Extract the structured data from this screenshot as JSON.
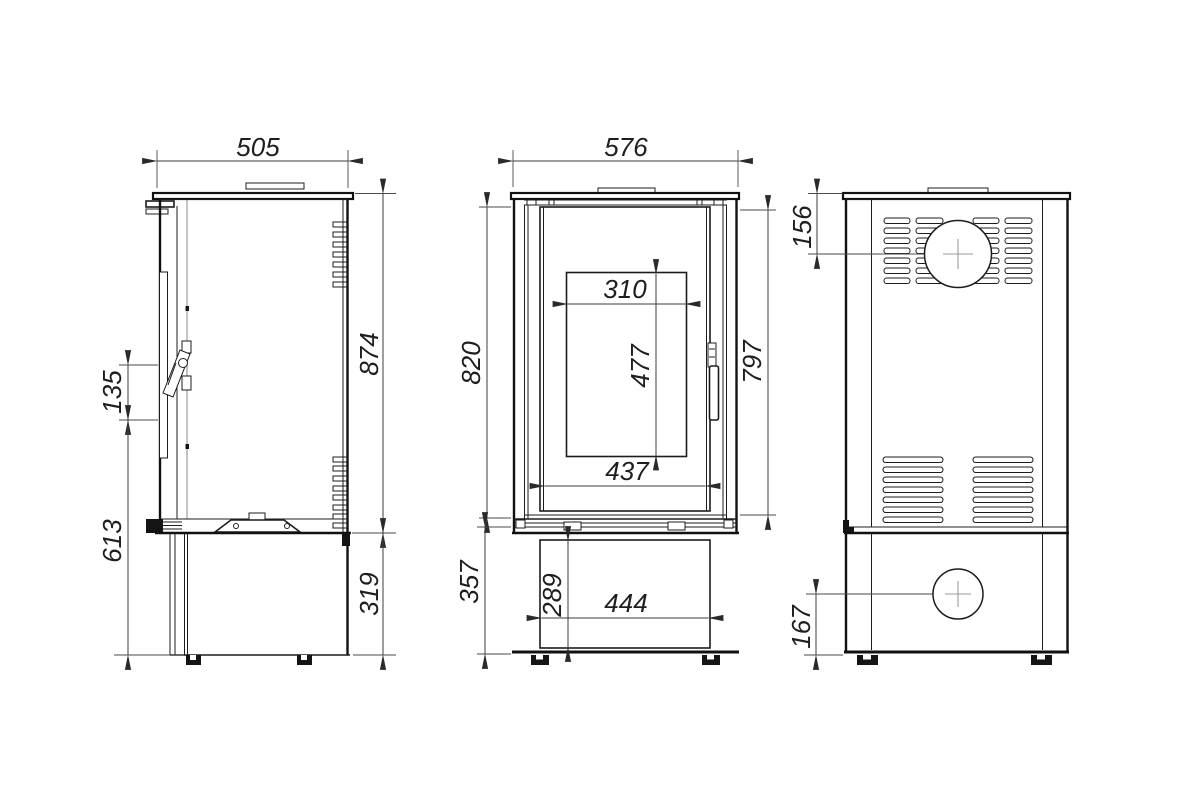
{
  "views": {
    "side": {
      "dims": {
        "top_width": "505",
        "body_height": "874",
        "handle_recess_height": "135",
        "front_lower_height": "613",
        "base_height": "319"
      }
    },
    "front": {
      "dims": {
        "top_width": "576",
        "body_height_left": "820",
        "door_height_right": "797",
        "glass_width": "310",
        "glass_height": "477",
        "door_inner_width": "437",
        "base_height": "357",
        "base_panel_height": "289",
        "base_panel_width": "444"
      }
    },
    "rear": {
      "dims": {
        "flue_center_from_top": "156",
        "inlet_center_from_bottom": "167"
      }
    }
  }
}
